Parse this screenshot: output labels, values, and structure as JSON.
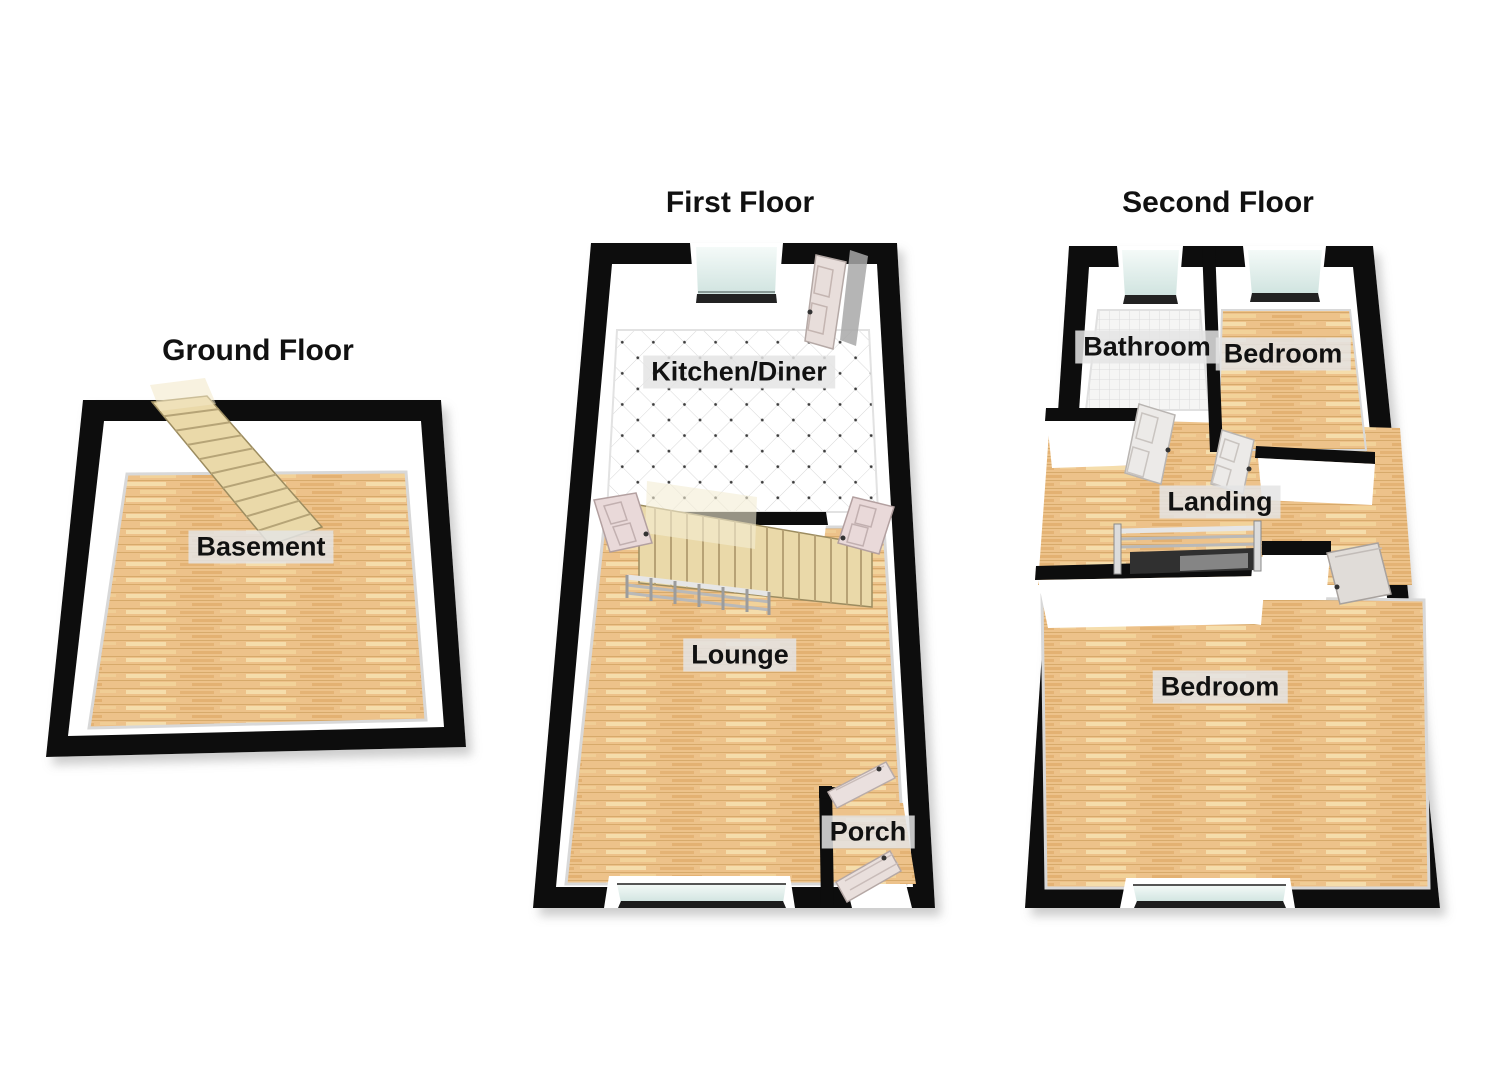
{
  "page": {
    "type": "3d-floorplan-set",
    "background": "#ffffff"
  },
  "floors": [
    {
      "id": "ground",
      "title": "Ground Floor",
      "rooms": [
        {
          "label": "Basement",
          "floor_finish": "wood"
        }
      ],
      "features": [
        "staircase"
      ]
    },
    {
      "id": "first",
      "title": "First Floor",
      "rooms": [
        {
          "label": "Kitchen/Diner",
          "floor_finish": "tile"
        },
        {
          "label": "Lounge",
          "floor_finish": "wood"
        },
        {
          "label": "Porch",
          "floor_finish": "wood"
        }
      ],
      "features": [
        "window-top",
        "window-bottom",
        "staircase",
        "railing",
        "doors"
      ]
    },
    {
      "id": "second",
      "title": "Second Floor",
      "rooms": [
        {
          "label": "Bathroom",
          "floor_finish": "tile"
        },
        {
          "label": "Bedroom",
          "floor_finish": "wood"
        },
        {
          "label": "Landing",
          "floor_finish": "wood"
        },
        {
          "label": "Bedroom",
          "floor_finish": "wood"
        }
      ],
      "features": [
        "window-bathroom",
        "window-bedroom",
        "window-bottom",
        "stair-opening",
        "railing",
        "doors"
      ]
    }
  ],
  "palette": {
    "wall": "#0d0d0d",
    "wall_face": "#ffffff",
    "wood_floor": "#edc28a",
    "wood_grain": "#c89a57",
    "kitchen_tile": "#ffffff",
    "tile_line": "#d8d8d8",
    "window_glass": "#d9ebe7",
    "stairs": "#ead9a9",
    "door": "#e9dcda",
    "railing": "#c6c6c6",
    "label_background": "#e4e4e4",
    "text": "#111111"
  }
}
